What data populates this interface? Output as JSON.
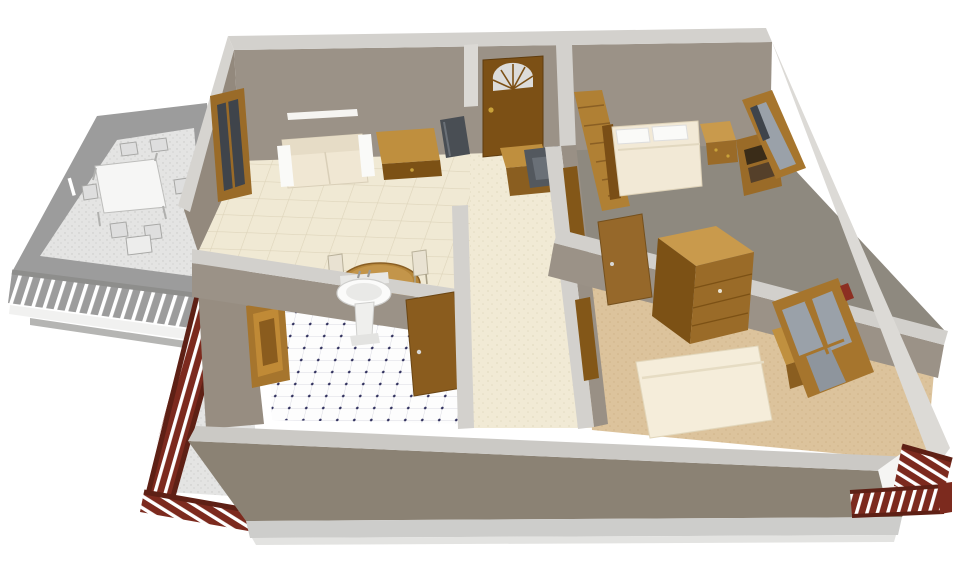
{
  "view": {
    "type": "3d-dollhouse-floor-plan-render",
    "width": 960,
    "height": 575,
    "camera": "elevated front orthographic view, walls cut at mid height",
    "background": "#ffffff"
  },
  "palette": {
    "background": "#ffffff",
    "wall_cap": "#d3d1cd",
    "wall_face": "#9b9287",
    "wall_face_dark": "#93897d",
    "exterior_front": "#8b8274",
    "right_wall_outer": "#dcdad6",
    "foundation": "#cdcdcb",
    "shadow": "#e3e3e1",
    "wood": "#9a6b28",
    "wood_dark": "#7c5115",
    "wood_light": "#c99a4c",
    "wood_mid": "#b5863a",
    "door_brown": "#7c5015",
    "tile_cream": "#f0e9d4",
    "tile_grout": "#ddd4ba",
    "hall_floor": "#f1ead5",
    "hall_speck": "#e4dcc2",
    "bath_tile": "#fdfdfd",
    "bath_grout": "#dadae3",
    "bath_dot": "#31315e",
    "carpet_tan": "#dcc39c",
    "carpet_speck": "#d0b488",
    "master_floor": "#8e897f",
    "bed_linen": "#f2e9d6",
    "pillow_white": "#fafaf8",
    "sofa_cream": "#f0e7d3",
    "railing_red": "#7c2a1e",
    "railing_red_dark": "#5e2015",
    "glass_gray": "#9aa1a9",
    "glass_dark": "#3f444b",
    "dark_furniture": "#53585e",
    "porch_rim": "#9c9c9c",
    "porch_floor": "#e4e4e3",
    "porch_speck": "#c9c9c7",
    "porch_white": "#f6f6f5",
    "brass": "#c9a23a"
  },
  "scene": {
    "exterior": {
      "deck_railing_color_name": "dark-red",
      "deck_railing_locations": [
        "front-left-side",
        "bottom-left-corner",
        "front-right-corner"
      ],
      "front_wall": "tan-gray stucco with light gray foundation strip"
    },
    "porch": {
      "name": "screened-porch",
      "render_style": "grayscale-preview",
      "furniture": [
        "rectangular-dining-table",
        "dining-chairs-x6",
        "railing-with-balusters"
      ]
    },
    "rooms": [
      {
        "name": "living-dining-room",
        "floor": "cream-tile",
        "furniture": [
          "loveseat",
          "wall-shelf",
          "wood-desk",
          "tv-dark",
          "round-dining-table",
          "two-side-chairs",
          "wood-cabinet",
          "dark-armchair",
          "sliding-glass-door-to-porch"
        ]
      },
      {
        "name": "entry-hall",
        "floor": "cream-tile",
        "features": [
          "front-door-with-arched-fanlight",
          "doors-to-bedrooms-and-bathroom"
        ]
      },
      {
        "name": "master-bedroom",
        "floor": "gray-carpet",
        "furniture": [
          "plank-wardrobe",
          "double-bed-with-two-pillows",
          "nightstand",
          "bookshelf"
        ],
        "windows": 1
      },
      {
        "name": "bathroom",
        "floor": "white-tile-with-navy-dots",
        "furniture": [
          "pedestal-sink"
        ],
        "features": [
          "wood-door",
          "side-window"
        ]
      },
      {
        "name": "second-bedroom",
        "floor": "tan-carpet",
        "furniture": [
          "chest-of-drawers",
          "bed",
          "desk-under-window"
        ],
        "windows": 2,
        "features": [
          "wood-door"
        ]
      }
    ]
  }
}
